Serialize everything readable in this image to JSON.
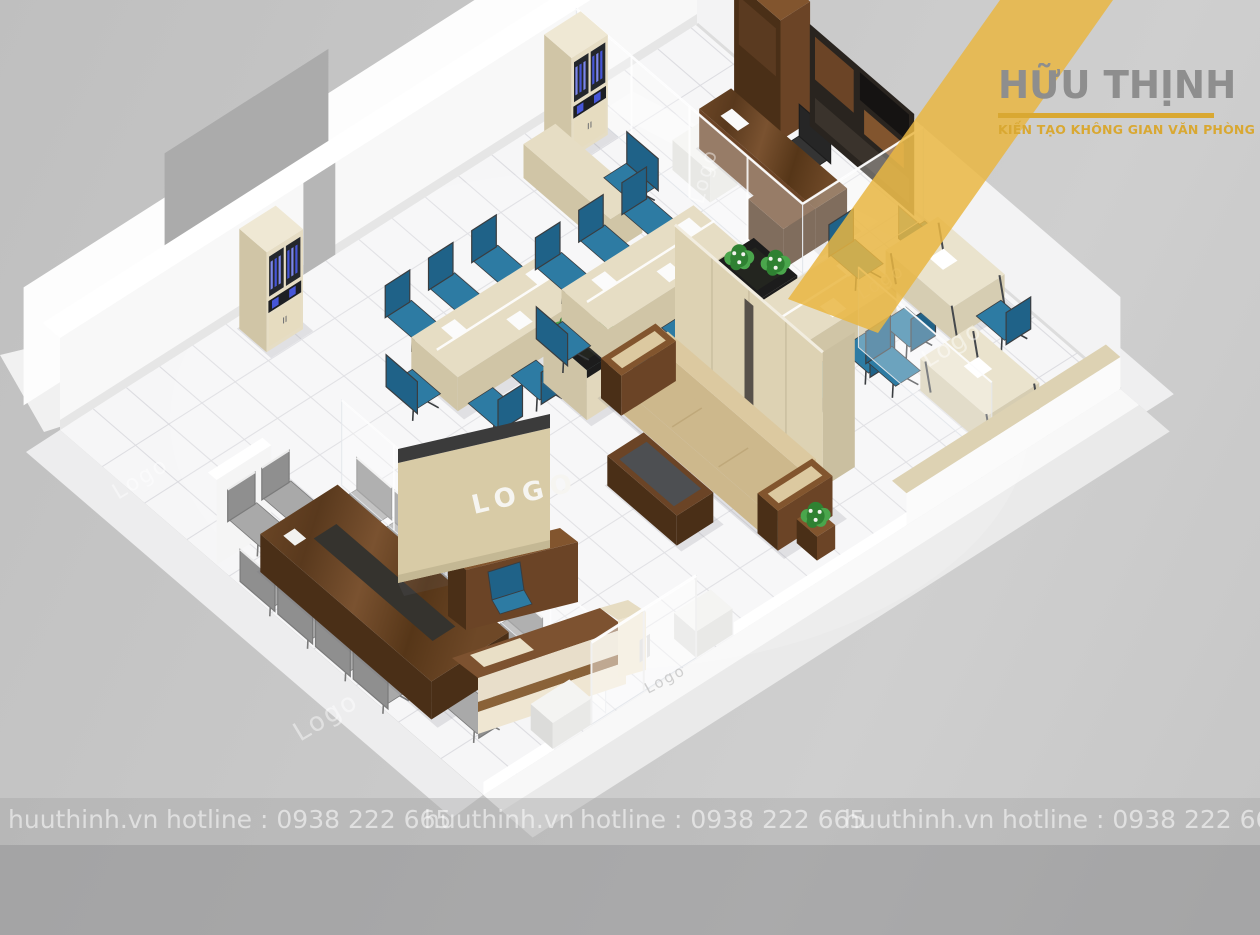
{
  "brand": {
    "name": "HỮU THỊNH",
    "tagline": "KIẾN TẠO KHÔNG GIAN VĂN PHÒNG",
    "name_color": "#8e8e8e",
    "gold": "#d9a832",
    "ribbon_color": "#e9b642"
  },
  "watermark": {
    "site": "huuthinh.vn",
    "hotline": "hotline : 0938 222 665",
    "repeats": 3,
    "text_color": "rgba(255,255,255,0.55)"
  },
  "scene": {
    "reception_logo": "LOGO",
    "glass_logo": "Logo",
    "colors": {
      "background": "#c6c6c6",
      "floor": "#f6f6f7",
      "tile_line": "#dbdbdf",
      "wall_white": "#f8f8f8",
      "wall_top": "#ffffff",
      "wall_shadow": "#e6e6e6",
      "outer_band": "#ededee",
      "outer_gray": "#ababab",
      "doorway_gray": "#b6b6b6",
      "walnut_dark": "#4a2f17",
      "walnut": "#6b4426",
      "walnut_light": "#82552e",
      "desk_beige": "#e6ddc4",
      "desk_beige_side": "#d0c5a6",
      "panel_beige": "#ddd2b3",
      "panel_beige_dark": "#cabfa0",
      "chair_blue": "#2d7ba3",
      "chair_blue_dark": "#1f6288",
      "chair_gray": "#a9a9a9",
      "chair_gray_dark": "#8f8f8f",
      "chair_frame": "#3a3d40",
      "sofa": "#dcc9a0",
      "sofa_dark": "#cdb88c",
      "table_top_dark": "#4d4f52",
      "plant_green": "#2f8132",
      "plant_green_light": "#4aa64c",
      "flower_white": "#f2f2ee",
      "binder_blue": "#4656d8",
      "binder_blue2": "#7b86ea",
      "cabinet_dark": "#24272c",
      "media_wall": "#29241f",
      "white_box": "#f4f4f2",
      "glass": "rgba(255,255,255,0.30)",
      "glass_edge": "rgba(228,231,235,0.95)",
      "shadow": "rgba(105,108,118,0.16)"
    }
  }
}
